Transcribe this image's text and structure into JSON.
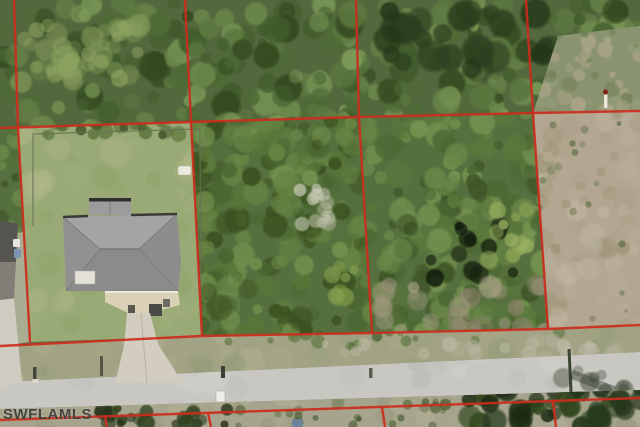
{
  "watermark": {
    "text": "SWFLAMLS"
  },
  "colors": {
    "parcel_line": "#cc2d1d",
    "forest": "#53683c",
    "brush": "#55703e",
    "scrub": "#8a9370",
    "lawn": "#9aaa76",
    "grass_dry": "#a2a384",
    "dirt": "#b3a791",
    "road": "#c8c7c2",
    "south_verge": "#a6a48d",
    "neighbor_pale": "#a9ad92",
    "roof_gray": "#969696",
    "driveway_concrete": "#d3cdbf",
    "logo_blue": "#6b84a8"
  },
  "overlay": {
    "stroke_width": 2.4,
    "opacity": 0.92,
    "lines": [
      {
        "name": "west-parcel-boundary",
        "points": [
          [
            14,
            0
          ],
          [
            18,
            128
          ],
          [
            30,
            342
          ]
        ]
      },
      {
        "name": "parcel-boundary-2",
        "points": [
          [
            185,
            0
          ],
          [
            191,
            122
          ],
          [
            202,
            336
          ]
        ]
      },
      {
        "name": "parcel-boundary-3",
        "points": [
          [
            356,
            0
          ],
          [
            359,
            117
          ],
          [
            372,
            333
          ]
        ]
      },
      {
        "name": "parcel-boundary-4",
        "points": [
          [
            526,
            0
          ],
          [
            533,
            113
          ],
          [
            548,
            329
          ]
        ]
      },
      {
        "name": "north-parcel-line",
        "points": [
          [
            0,
            128
          ],
          [
            191,
            122
          ],
          [
            359,
            117
          ],
          [
            533,
            113
          ],
          [
            640,
            111
          ]
        ]
      },
      {
        "name": "south-parcel-line",
        "points": [
          [
            0,
            346
          ],
          [
            202,
            336
          ],
          [
            372,
            333
          ],
          [
            548,
            329
          ],
          [
            640,
            325
          ]
        ]
      },
      {
        "name": "road-south-parcel-line",
        "points": [
          [
            0,
            420
          ],
          [
            553,
            401
          ],
          [
            640,
            398
          ]
        ]
      },
      {
        "name": "south-tick-1",
        "points": [
          [
            105,
            416
          ],
          [
            107,
            427
          ]
        ]
      },
      {
        "name": "south-tick-2",
        "points": [
          [
            208,
            413
          ],
          [
            211,
            427
          ]
        ]
      },
      {
        "name": "south-tick-3",
        "points": [
          [
            382,
            407
          ],
          [
            385,
            427
          ]
        ]
      },
      {
        "name": "south-tick-4",
        "points": [
          [
            553,
            401
          ],
          [
            556,
            427
          ]
        ]
      }
    ]
  }
}
